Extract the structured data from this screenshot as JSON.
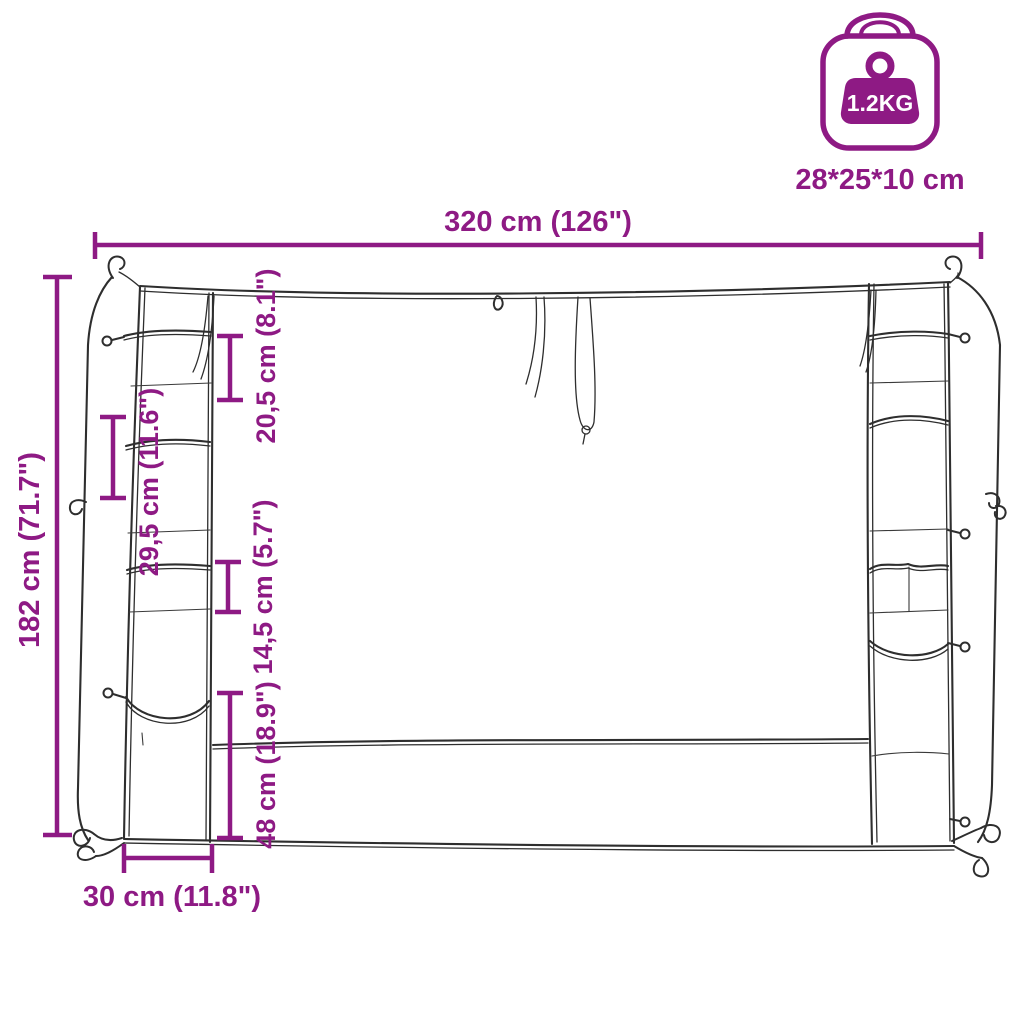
{
  "product_diagram": {
    "title": "pocket organizer cover dimension sketch",
    "dimensions": {
      "total_width": "320 cm (126\")",
      "total_height": "182 cm (71.7\")",
      "top_pocket_height": "20,5 cm (8.1\")",
      "large_pocket_height": "29,5 cm (11.6\")",
      "small_pocket_height": "14,5 cm (5.7\")",
      "bottom_section_height": "48 cm (18.9\")",
      "side_panel_width": "30 cm (11.8\")"
    },
    "packaging": {
      "weight": "1.2KG",
      "box_size": "28*25*10 cm"
    },
    "colors": {
      "accent": "#8E1A84",
      "sketch_line": "#2e2e2e",
      "background": "#FFFFFF"
    },
    "icons": {
      "package": "package-weight-icon"
    }
  }
}
